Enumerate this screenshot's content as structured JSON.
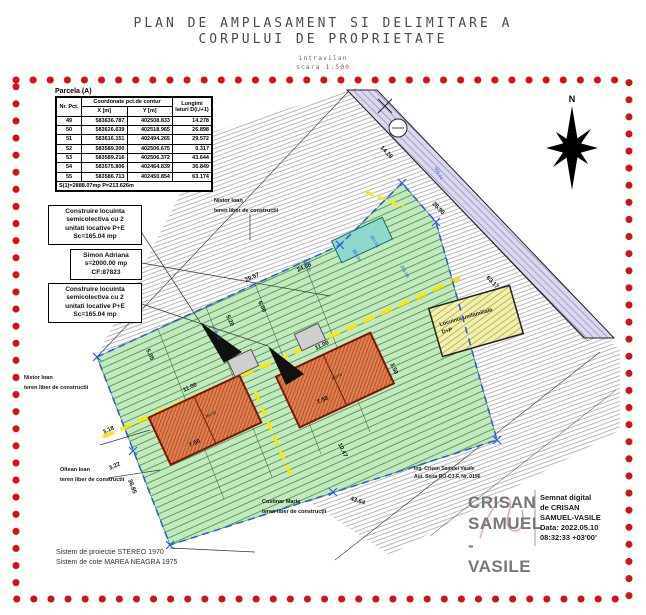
{
  "page": {
    "title_line1": "PLAN DE AMPLASAMENT SI DELIMITARE A",
    "title_line2": "CORPULUI DE PROPRIETATE",
    "subtitle1": "intravilan",
    "subtitle2": "scara 1:500"
  },
  "coords_table": {
    "caption": "Parcela (A)",
    "col_point": "Nr. Pct.",
    "col_coords": "Coordonate pct.de contur",
    "col_x": "X [m]",
    "col_y": "Y [m]",
    "col_length": "Lungimi laturi D(i,i+1)",
    "rows": [
      {
        "nr": "49",
        "x": "583636.787",
        "y": "402508.833",
        "len": "14.278"
      },
      {
        "nr": "50",
        "x": "583626.639",
        "y": "402518.965",
        "len": "26.898"
      },
      {
        "nr": "51",
        "x": "583616.151",
        "y": "402494.265",
        "len": "29.572"
      },
      {
        "nr": "52",
        "x": "583589.300",
        "y": "402506.675",
        "len": "0.317"
      },
      {
        "nr": "53",
        "x": "583589.216",
        "y": "402506.372",
        "len": "43.644"
      },
      {
        "nr": "54",
        "x": "583575.806",
        "y": "402464.839",
        "len": "36.849"
      },
      {
        "nr": "55",
        "x": "583586.713",
        "y": "402450.854",
        "len": "63.174"
      }
    ],
    "footer": "S(1)=2888.07mp  P=213.626m"
  },
  "annotation_boxes": {
    "box1": [
      "Construire locuinta",
      "semicolectiva cu 2",
      "unitati locative P+E",
      "Sc=165.04 mp"
    ],
    "box2": [
      "Simon Adriana",
      "s=2000.00 mp",
      "CF:87823"
    ],
    "box3": [
      "Construire locuinta",
      "semicolectiva cu 2",
      "unitati locative P+E",
      "Sc=165.04 mp"
    ]
  },
  "owners": [
    {
      "name": "Nistor Ioan",
      "status": "teren liber de constructii"
    },
    {
      "name": "Nistor Ioan",
      "status": "teren liber de constructii"
    },
    {
      "name": "Oltean Ioan",
      "status": "teren liber de constructii"
    },
    {
      "name": "Costinar Maria",
      "status": "teren liber de construcții"
    }
  ],
  "drawing": {
    "compass": "N",
    "house_label1": "Locuinta unifamiliala",
    "house_label2": "D+P",
    "dims": [
      "11.00",
      "7.50",
      "3.50",
      "11.00",
      "7.50",
      "3.18",
      "3.22",
      "10.47",
      "43.64",
      "36.85",
      "63.17",
      "14.28",
      "26.90",
      "29.57",
      "5.05",
      "5.20",
      "6.00",
      "24.08"
    ],
    "elevations": [
      "383.06",
      "391.06",
      "393.08",
      "385.00",
      "379.12",
      "400.41",
      "384.68",
      "384.69"
    ]
  },
  "engineer": {
    "line1": "Ing. Crișan Samuel Vasile",
    "line2": "Aut. Seria RO-CJ-F, Nr. 0196"
  },
  "signature": {
    "name_line1": "CRISAN",
    "name_line2": "SAMUEL",
    "name_line3": "-VASILE",
    "details": [
      "Semnat digital",
      "de CRISAN",
      "SAMUEL-VASILE",
      "Data: 2022.05.10",
      "08:32:33 +03'00'"
    ]
  },
  "footer_notes": {
    "line1": "Sistem de proiectie STEREO 1970",
    "line2": "Sistem de cote MAREA NEAGRA 1975"
  },
  "colors": {
    "border_red": "#d01318",
    "parcel_green": "#c4e9bf",
    "green_hatch": "#55a05a",
    "building_orange": "#e2814f",
    "building_stroke": "#7a1608",
    "road_lilac": "#dcd7f0",
    "boundary_blue": "#2b5fd9",
    "axis_yellow": "#ffe600",
    "teal_parcel": "#8fd8cc",
    "house_yellow": "#f4f0a4"
  }
}
